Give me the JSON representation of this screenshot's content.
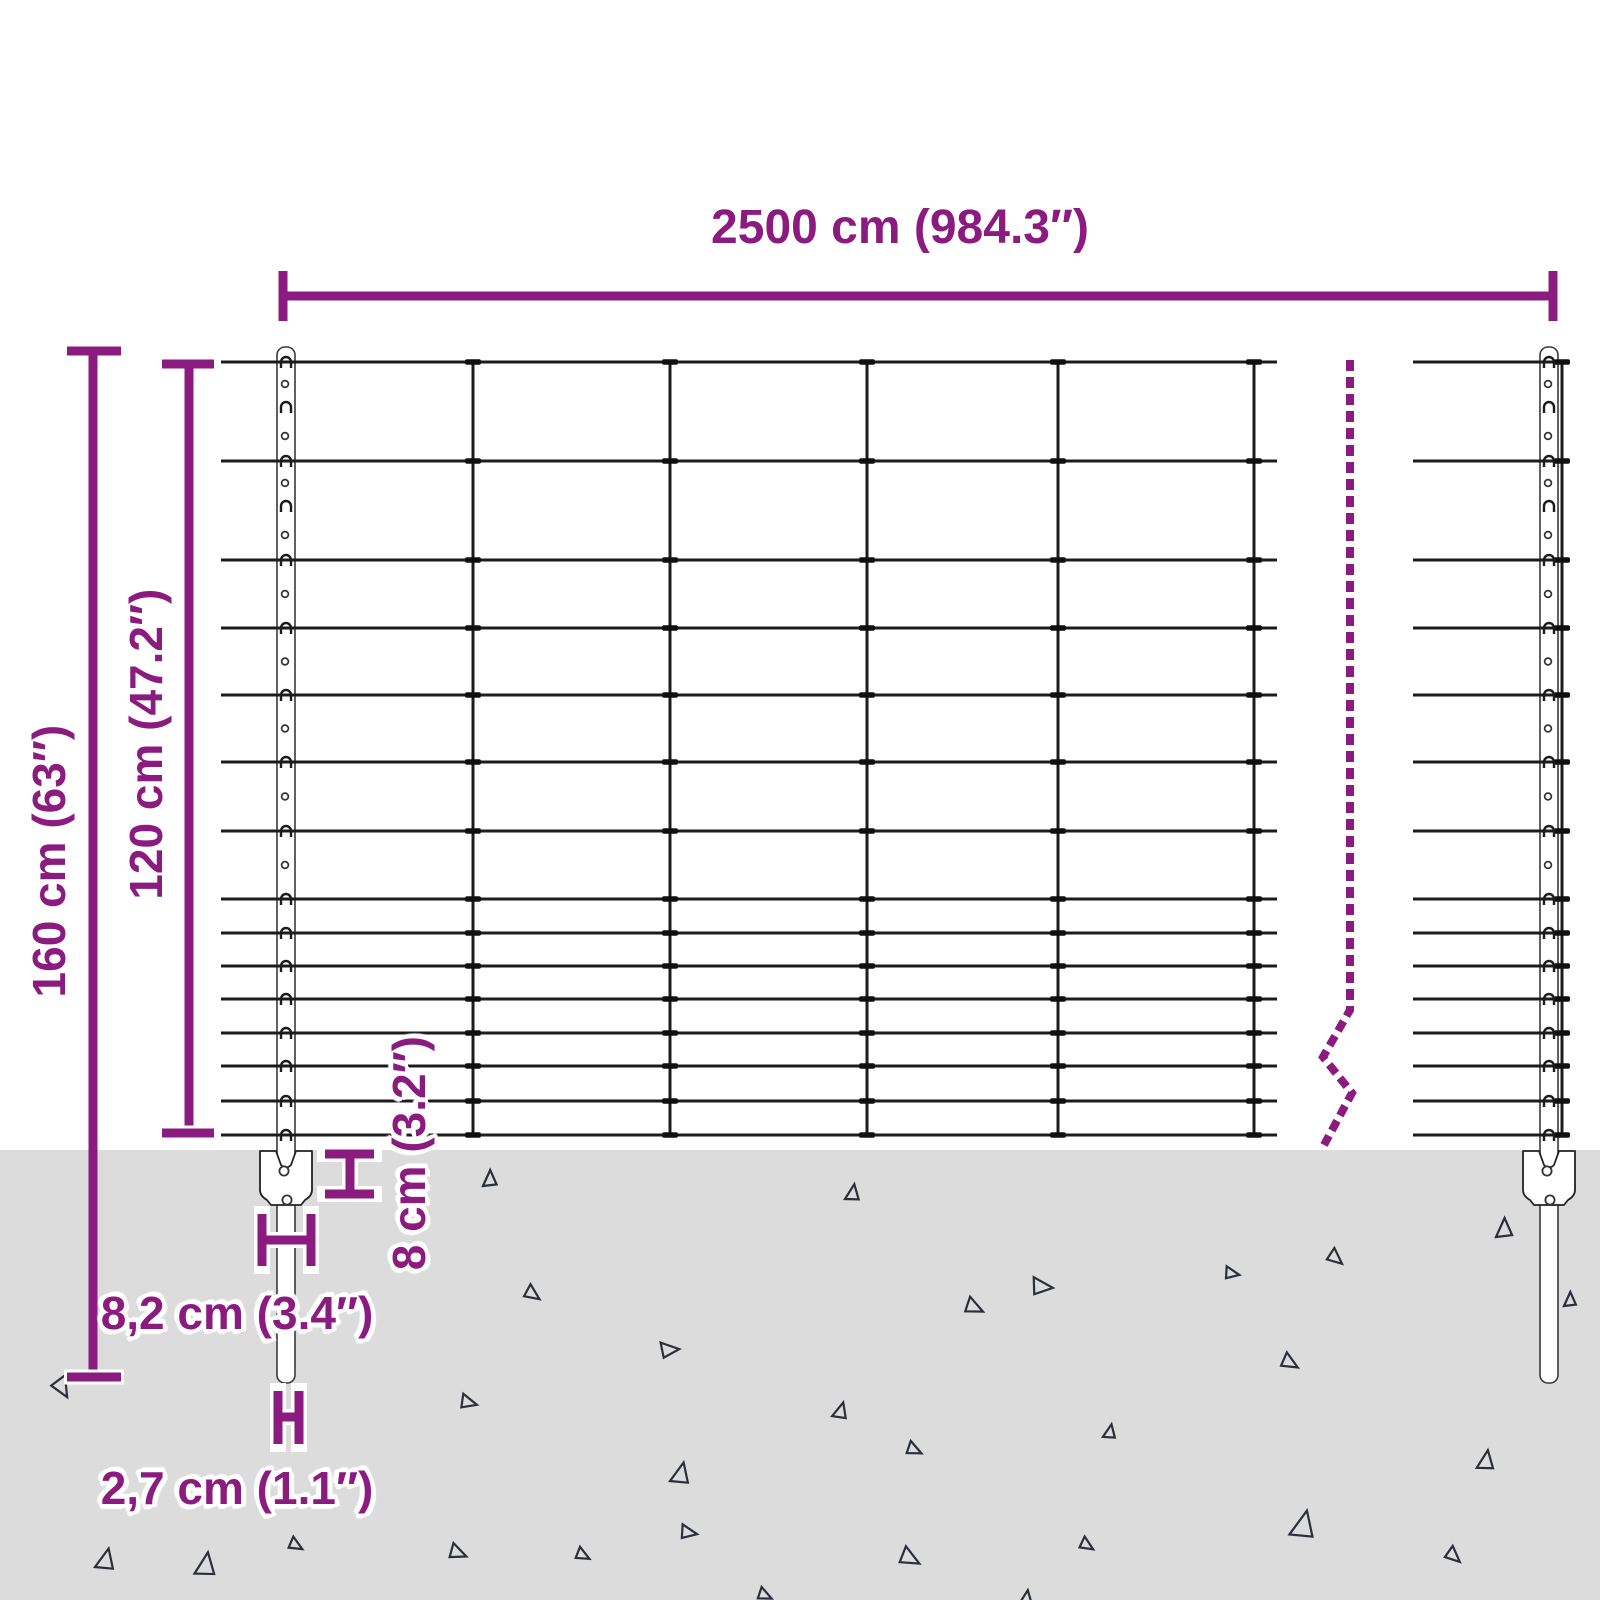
{
  "labels": {
    "span": "2500 cm (984.3″)",
    "total_height": "160 cm (63″)",
    "net_height": "120 cm (47.2″)",
    "plate_height": "8 cm (3.2″)",
    "plate_width": "8,2 cm (3.4″)",
    "post_thickness": "2,7 cm (1.1″)"
  },
  "colors": {
    "accent": "#8C1B7F",
    "wire": "#1c1c1c",
    "knot": "#101010",
    "post_outline": "#3a3a3a",
    "ground": "#dcdcdc",
    "speckle": "#2b2f3a",
    "halo": "#ffffff"
  },
  "fence": {
    "wire_ys": [
      362,
      461,
      560,
      628,
      695,
      762,
      831,
      899,
      933,
      966,
      999,
      1033,
      1066,
      1101,
      1135
    ],
    "left_section": {
      "x1": 221,
      "x2": 1277
    },
    "right_section": {
      "x1": 1413,
      "x2": 1570
    },
    "stay_xs": [
      473,
      670,
      867,
      1058,
      1254
    ],
    "end_stay_x": 1562,
    "top": 362,
    "bottom": 1135
  },
  "posts": {
    "left_cx": 286,
    "right_cx": 1549,
    "width": 18,
    "top": 347,
    "rod_bottom": 1383,
    "plate": {
      "w": 52,
      "h": 54,
      "top": 1151
    }
  },
  "dims": {
    "span": {
      "y": 296,
      "x1": 283,
      "x2": 1553,
      "tick_h": 50
    },
    "total": {
      "x": 93,
      "y1": 351,
      "y2": 1377,
      "tick_w": 54,
      "tick_x": 67
    },
    "net": {
      "x": 189,
      "y1": 364,
      "y2": 1133,
      "tick_w": 52,
      "tick_x": 162
    },
    "plate_h_bracket": "M325,1154 H374 M325,1194 H374 M350,1154 V1194",
    "plate_w_bracket": "M262,1214 V1266 M311,1214 V1266 M262,1240 H311",
    "thickness_bracket": "M278,1391 V1444 M299,1391 V1444 M278,1417 H299"
  },
  "break_line": {
    "x": 1350,
    "top": 360,
    "straight_bottom": 1010,
    "zigzag": [
      [
        1323,
        1057
      ],
      [
        1352,
        1093
      ],
      [
        1324,
        1145
      ]
    ],
    "dash": "11 6",
    "width": 8
  },
  "ground": {
    "top": 1150,
    "speckles": [
      [
        55,
        1378,
        20,
        150
      ],
      [
        483,
        1170,
        16,
        0
      ],
      [
        846,
        1184,
        16,
        8
      ],
      [
        1496,
        1218,
        19,
        0
      ],
      [
        1330,
        1250,
        16,
        130
      ],
      [
        1227,
        1266,
        14,
        100
      ],
      [
        1035,
        1276,
        20,
        95
      ],
      [
        968,
        1298,
        18,
        115
      ],
      [
        527,
        1286,
        16,
        125
      ],
      [
        663,
        1340,
        18,
        85
      ],
      [
        1284,
        1354,
        17,
        120
      ],
      [
        463,
        1394,
        16,
        105
      ],
      [
        834,
        1402,
        16,
        15
      ],
      [
        1104,
        1424,
        14,
        10
      ],
      [
        909,
        1442,
        15,
        115
      ],
      [
        1478,
        1450,
        19,
        8
      ],
      [
        672,
        1462,
        21,
        12
      ],
      [
        1564,
        1292,
        14,
        0
      ],
      [
        97,
        1548,
        21,
        12
      ],
      [
        196,
        1552,
        23,
        8
      ],
      [
        291,
        1538,
        14,
        120
      ],
      [
        452,
        1544,
        17,
        112
      ],
      [
        578,
        1548,
        14,
        118
      ],
      [
        683,
        1524,
        16,
        100
      ],
      [
        903,
        1548,
        20,
        118
      ],
      [
        1082,
        1538,
        14,
        122
      ],
      [
        1292,
        1510,
        27,
        12
      ],
      [
        1448,
        1548,
        16,
        132
      ],
      [
        760,
        1588,
        14,
        115
      ],
      [
        1020,
        1590,
        15,
        8
      ]
    ]
  }
}
